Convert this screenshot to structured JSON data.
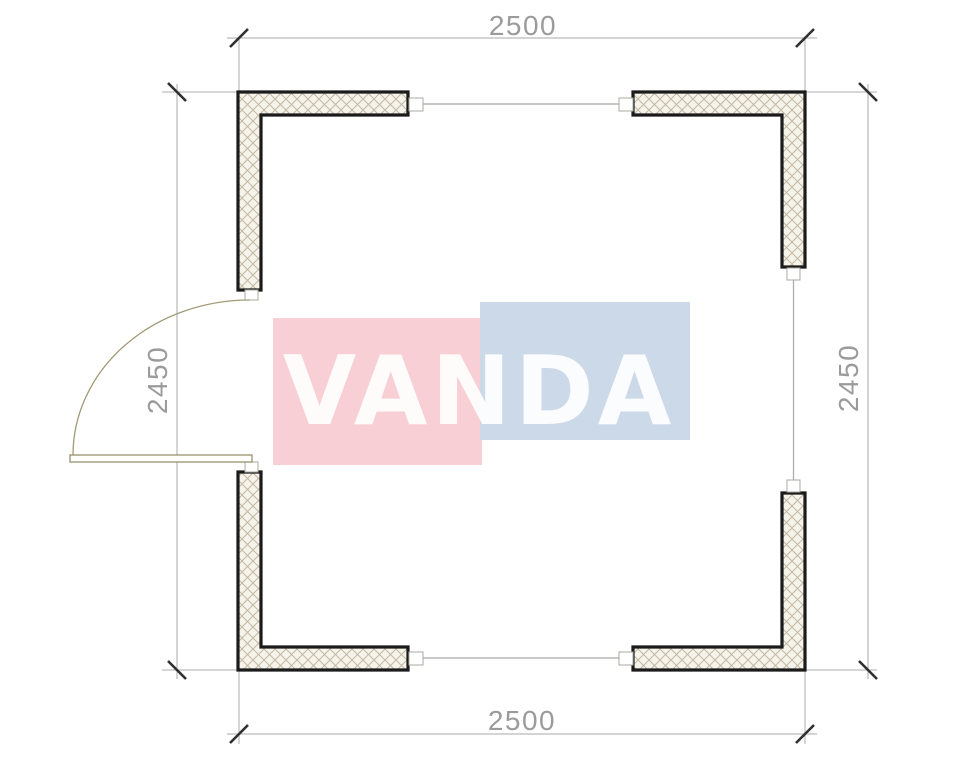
{
  "drawing": {
    "kind": "floor-plan",
    "dimensions": {
      "top": "2500",
      "bottom": "2500",
      "left": "2450",
      "right": "2450"
    },
    "watermark": {
      "text": "VANDA",
      "pink_block_color": "#f8cfd5",
      "blue_block_color": "#ccd9e9",
      "letter_color": "#ffffff"
    },
    "colors": {
      "background": "#ffffff",
      "wall_outline": "#1b1b1b",
      "wall_fill": "#f6f3ea",
      "hatch_line": "#c2b8a5",
      "dimension_line": "#a9a9a9",
      "dimension_text": "#9b9b9b",
      "tick_mark": "#2f2f2f",
      "connector_border": "#a9a9a2",
      "door_line": "#98916c"
    }
  }
}
